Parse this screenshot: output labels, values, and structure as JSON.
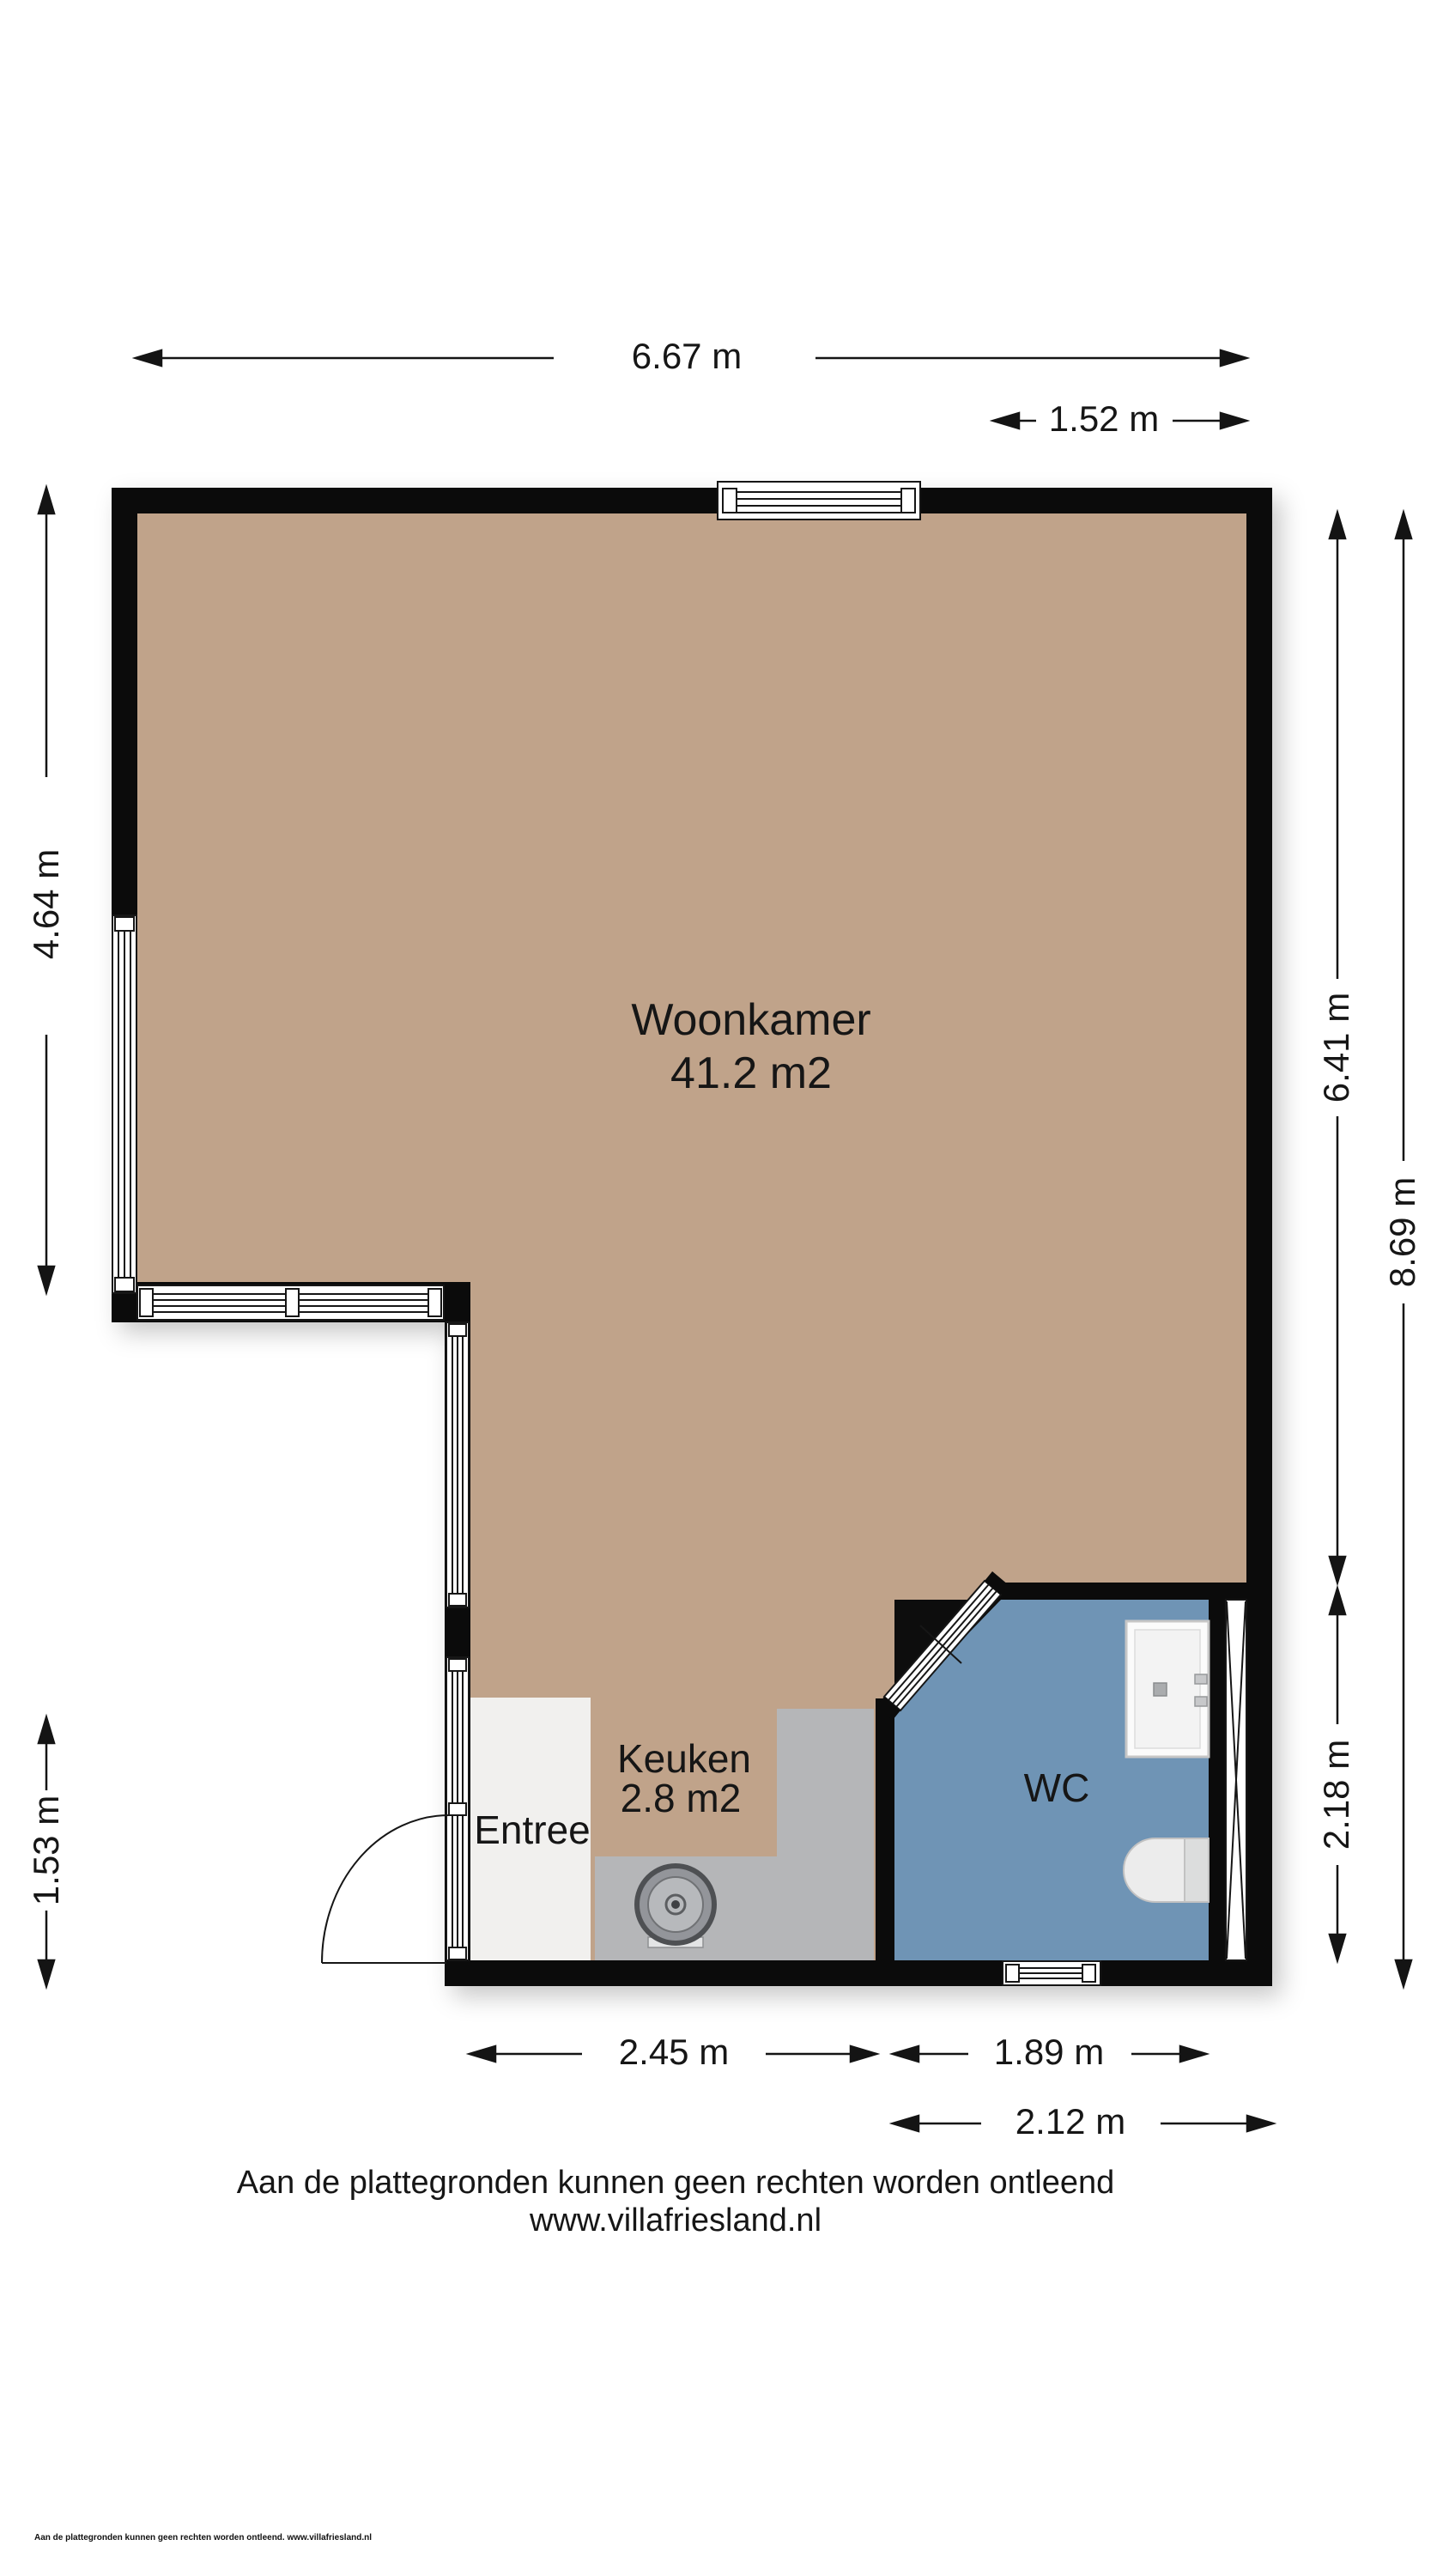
{
  "rooms": {
    "woonkamer": {
      "name": "Woonkamer",
      "area": "41.2 m2"
    },
    "keuken": {
      "name": "Keuken",
      "area": "2.8 m2"
    },
    "entree": {
      "name": "Entree"
    },
    "wc": {
      "name": "WC"
    }
  },
  "dimensions": {
    "top_total": "6.67 m",
    "top_right": "1.52 m",
    "left_upper": "4.64 m",
    "left_lower": "1.53 m",
    "right_woonkamer": "6.41 m",
    "right_wc": "2.18 m",
    "right_total": "8.69 m",
    "bottom_keuken": "2.45 m",
    "bottom_wc_inner": "1.89 m",
    "bottom_wc_outer": "2.12 m"
  },
  "footer": {
    "disclaimer": "Aan de plattegronden kunnen geen rechten worden ontleend",
    "website": "www.villafriesland.nl",
    "fine_print": "Aan de plattegronden kunnen geen rechten worden ontleend. www.villafriesland.nl"
  },
  "colors": {
    "wall": "#0b0b0b",
    "floor_woonkamer": "#c0a38a",
    "floor_wc": "#6f94b5",
    "floor_entree": "#f1f0ee",
    "counter": "#b5b6b8"
  }
}
